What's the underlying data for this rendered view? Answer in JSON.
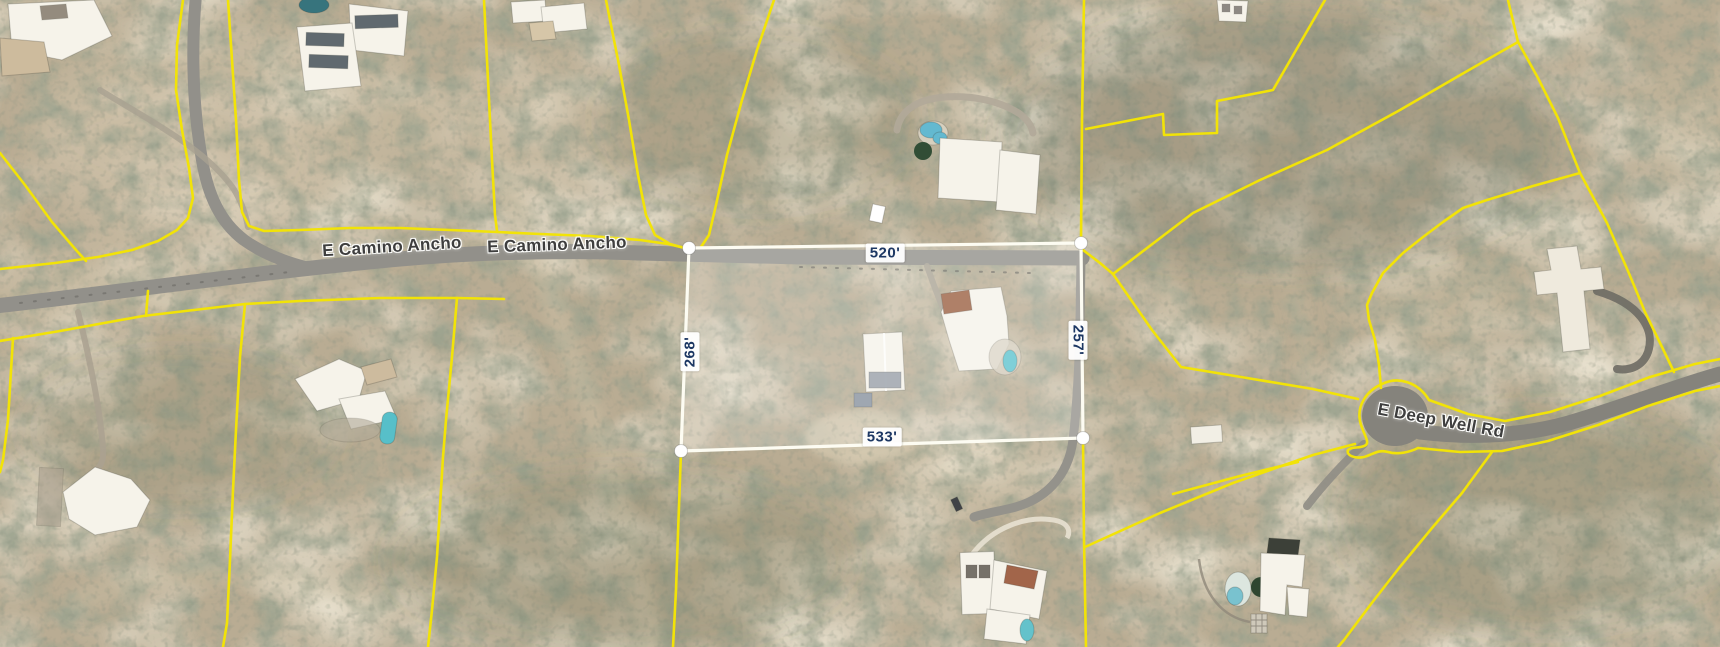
{
  "map": {
    "view_type": "aerial-parcel-map",
    "road_labels": [
      {
        "id": "camino-ancho-west",
        "text": "E Camino Ancho"
      },
      {
        "id": "camino-ancho-east",
        "text": "E Camino Ancho"
      },
      {
        "id": "deep-well",
        "text": "E Deep Well Rd"
      }
    ],
    "measurement": {
      "top": "520'",
      "left": "268'",
      "right": "257'",
      "bottom": "533'"
    },
    "colors": {
      "parcel_boundary": "#f2e307",
      "highlight_outline": "#fdfcf2",
      "highlight_fill": "rgba(255,255,255,0.2)",
      "measurement_text": "#1c3763",
      "road_label_text": "#3e3e3e",
      "road_surface": "#92908a",
      "terrain_base": "#b9ac93",
      "pool_water": "#5fc3cf"
    }
  }
}
